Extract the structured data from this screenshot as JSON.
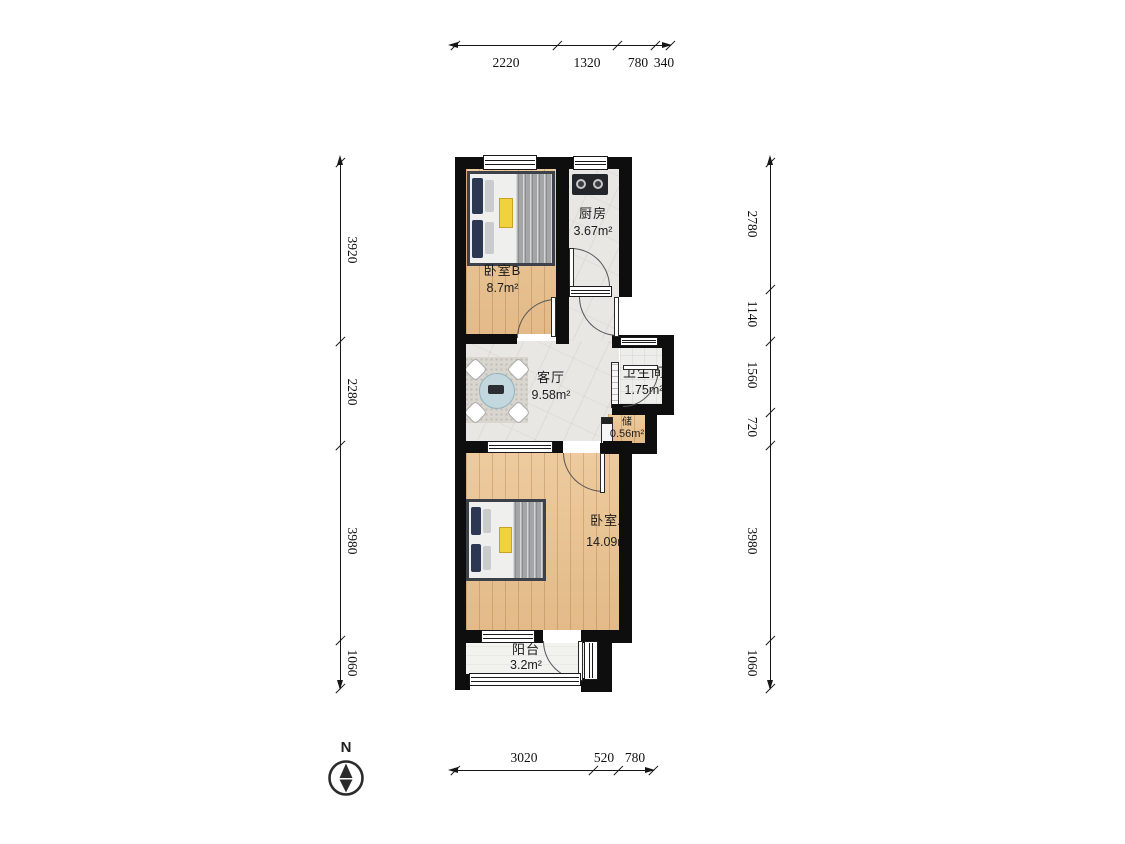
{
  "rooms": [
    {
      "id": "bedroom-b",
      "name": "卧室B",
      "area": "8.7m²"
    },
    {
      "id": "kitchen",
      "name": "厨房",
      "area": "3.67m²"
    },
    {
      "id": "living-room",
      "name": "客厅",
      "area": "9.58m²"
    },
    {
      "id": "bathroom",
      "name": "卫生间",
      "area": "1.75m²"
    },
    {
      "id": "storage",
      "name": "储",
      "area": "0.56m²"
    },
    {
      "id": "bedroom-a",
      "name": "卧室A",
      "area": "14.09m²"
    },
    {
      "id": "balcony",
      "name": "阳台",
      "area": "3.2m²"
    }
  ],
  "dimensions": {
    "top": [
      "2220",
      "1320",
      "780",
      "340"
    ],
    "bottom": [
      "3020",
      "520",
      "780"
    ],
    "left": [
      "3920",
      "2280",
      "3980",
      "1060"
    ],
    "right": [
      "2780",
      "1140",
      "1560",
      "720",
      "3980",
      "1060"
    ]
  },
  "compass": {
    "label": "N"
  },
  "colors": {
    "wall": "#0e0e0e",
    "wood_floor": "#eac695",
    "tile_floor": "#e9e7e3",
    "balcony_floor": "#f2f2ef",
    "bed_frame": "#3c414a",
    "pillow_navy": "#2c3853",
    "blanket_gray": "#a3a5a7",
    "accent_yellow": "#f2d23c",
    "table_blue": "#c2d8de",
    "dim_line": "#161616"
  }
}
